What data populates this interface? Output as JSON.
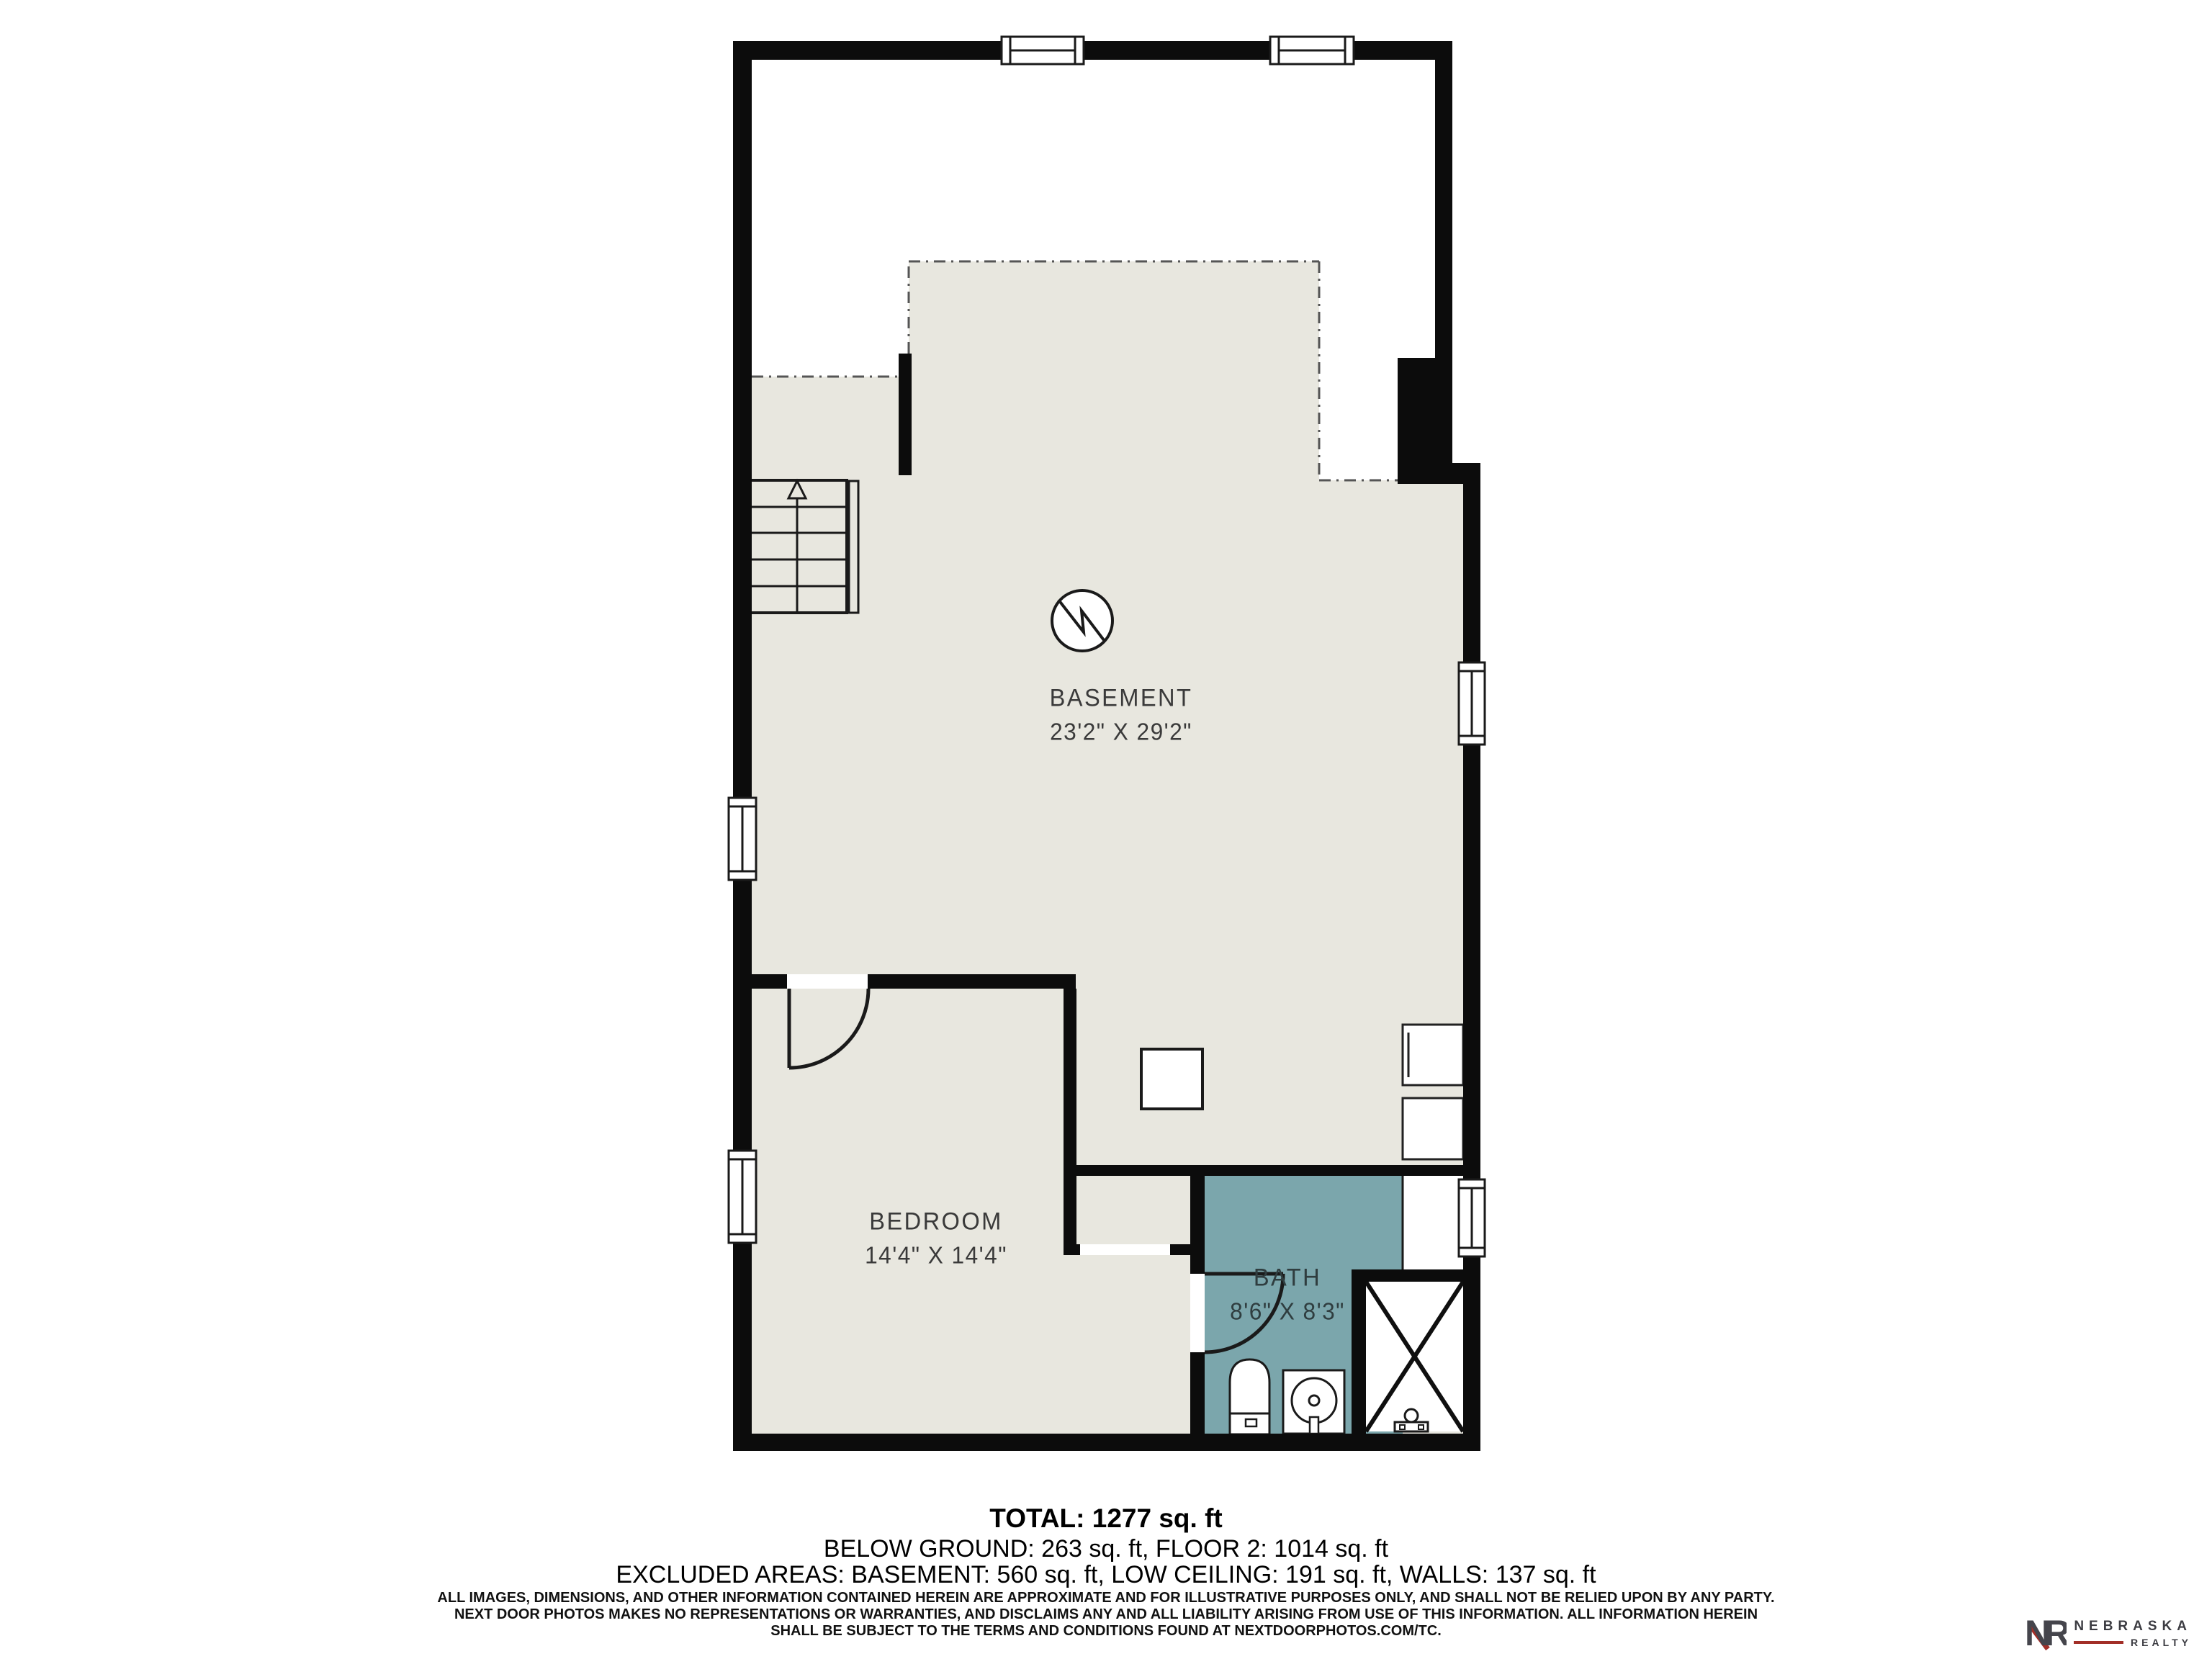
{
  "rooms": {
    "basement": {
      "name": "BASEMENT",
      "dimensions": "23'2\" X 29'2\""
    },
    "bedroom": {
      "name": "BEDROOM",
      "dimensions": "14'4\" X 14'4\""
    },
    "bath": {
      "name": "BATH",
      "dimensions": "8'6\" X 8'3\""
    }
  },
  "summary": {
    "total": "TOTAL: 1277 sq. ft",
    "below_ground": "BELOW GROUND: 263 sq. ft, FLOOR 2: 1014 sq. ft",
    "excluded": "EXCLUDED AREAS: BASEMENT: 560 sq. ft, LOW CEILING: 191 sq. ft, WALLS: 137 sq. ft"
  },
  "disclaimer": {
    "line1": "ALL IMAGES, DIMENSIONS, AND OTHER INFORMATION CONTAINED HEREIN ARE APPROXIMATE AND FOR ILLUSTRATIVE PURPOSES ONLY, AND SHALL NOT BE RELIED UPON BY ANY PARTY.",
    "line2": "NEXT DOOR PHOTOS MAKES NO REPRESENTATIONS OR WARRANTIES, AND DISCLAIMS ANY AND ALL LIABILITY ARISING FROM USE OF THIS INFORMATION. ALL INFORMATION HEREIN",
    "line3": "SHALL BE SUBJECT TO THE TERMS AND CONDITIONS FOUND AT NEXTDOORPHOTOS.COM/TC."
  },
  "branding": {
    "monogram": "NR",
    "name": "NEBRASKA",
    "subname": "REALTY"
  },
  "icons": {
    "north_indicator": "north-indicator-icon",
    "stairs_direction": "up-arrow-icon",
    "shower_area": "x-cross-icon"
  },
  "colors": {
    "floor": "#e8e7df",
    "bath_floor": "#7ba6ac",
    "wall": "#0c0c0c",
    "dashed_line": "#555555",
    "label_text": "#3a3a3a",
    "logo_red": "#a22f28",
    "logo_gray": "#3c3c42"
  }
}
